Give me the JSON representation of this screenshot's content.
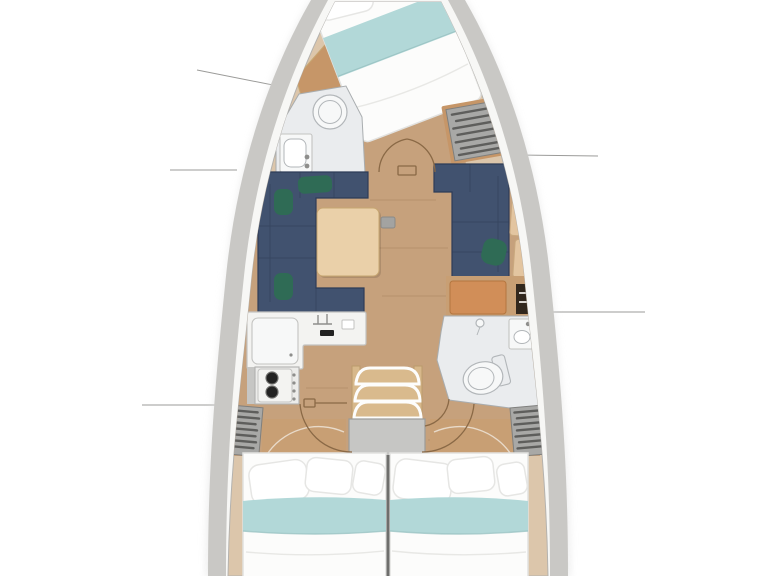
{
  "canvas": {
    "width": 768,
    "height": 576
  },
  "colors": {
    "background": "#ffffff",
    "callout": "#9b9b99",
    "hull_outer": "#c9c8c5",
    "hull_band": "#f7f7f5",
    "hull_line": "#b4b2ae",
    "deck": "#dcc6ab",
    "deck_seam": "#c4ac8e",
    "floor": "#c6a17c",
    "floor_seam": "#ab855f",
    "wood_panel": "#c69668",
    "headboard": "#c89f74",
    "headboard_arc": "#f0e9df",
    "sofa": "#41526f",
    "sofa_seam": "#2e3c57",
    "cushion": "#2f6b55",
    "table": "#ead0a9",
    "table_edge": "#c7a671",
    "post": "#a3a3a1",
    "post_edge": "#8a8a88",
    "counter": "#f3f3f1",
    "counter_edge": "#c3c3c1",
    "appliance": "#ececea",
    "appliance_edge": "#b1b1af",
    "burner": "#222222",
    "burner_ring": "#6f6f6d",
    "knob": "#8e8e8c",
    "steps_wood": "#d9ba8d",
    "steps_frame": "#fdfdfc",
    "rail_wood": "#d7b88b",
    "rail_edge": "#bb9a6b",
    "platform": "#c6c6c4",
    "platform_edge": "#9c9c9a",
    "locker_bg": "#a8a8a6",
    "locker_slat": "#5e5e5c",
    "locker_frame": "#7f7f7d",
    "head_floor": "#eaecee",
    "head_edge": "#a9adaf",
    "fixture": "#f7f8f8",
    "fixture_line": "#b2b6b9",
    "bed": "#fcfcfb",
    "bed_line": "#e2e2e0",
    "blanket": "#b2d8d8",
    "blanket_line": "#9cc4c4",
    "pillow": "#ffffff",
    "pillow_line": "#e6e6e4",
    "seat": "#d18e58",
    "seat_edge": "#b4763f",
    "cabinet": "#31271d",
    "cabinet_slat": "#d8d4cf",
    "door": "#8a6946",
    "bulkhead": "#6e6e6c",
    "trim_wood": "#e3c5a0",
    "trim_edge": "#c9a87e",
    "shadow": "#dedede"
  },
  "callouts": [
    {
      "x1": 197,
      "y1": 70,
      "x2": 288,
      "y2": 88
    },
    {
      "x1": 170,
      "y1": 170,
      "x2": 237,
      "y2": 170
    },
    {
      "x1": 142,
      "y1": 405,
      "x2": 240,
      "y2": 405
    },
    {
      "x1": 518,
      "y1": 155,
      "x2": 598,
      "y2": 156
    },
    {
      "x1": 549,
      "y1": 312,
      "x2": 645,
      "y2": 312
    }
  ],
  "inventory": {
    "forward_cabin": [
      "v-berth-double-bed",
      "pillows",
      "teal-blanket",
      "wood-wardrobe-panel",
      "hanging-locker"
    ],
    "forward_head": [
      "shower-toilet",
      "sink-cabinet",
      "faucet"
    ],
    "salon": [
      "port-c-shaped-sofa",
      "starboard-l-shaped-sofa",
      "green-cushions",
      "dining-table",
      "mast-post"
    ],
    "navigation": [
      "chart-seat",
      "electrical-cabinet"
    ],
    "galley": [
      "l-shaped-counter",
      "fridge-top-lid",
      "sink-faucet",
      "two-burner-stove"
    ],
    "companionway": [
      "three-steps",
      "engine-platform"
    ],
    "aft_head": [
      "toilet",
      "sink",
      "shower-fixture"
    ],
    "aft_cabins": [
      "port-double-bed",
      "starboard-double-bed",
      "hanging-lockers",
      "door-swing-arcs",
      "center-bulkhead"
    ]
  }
}
